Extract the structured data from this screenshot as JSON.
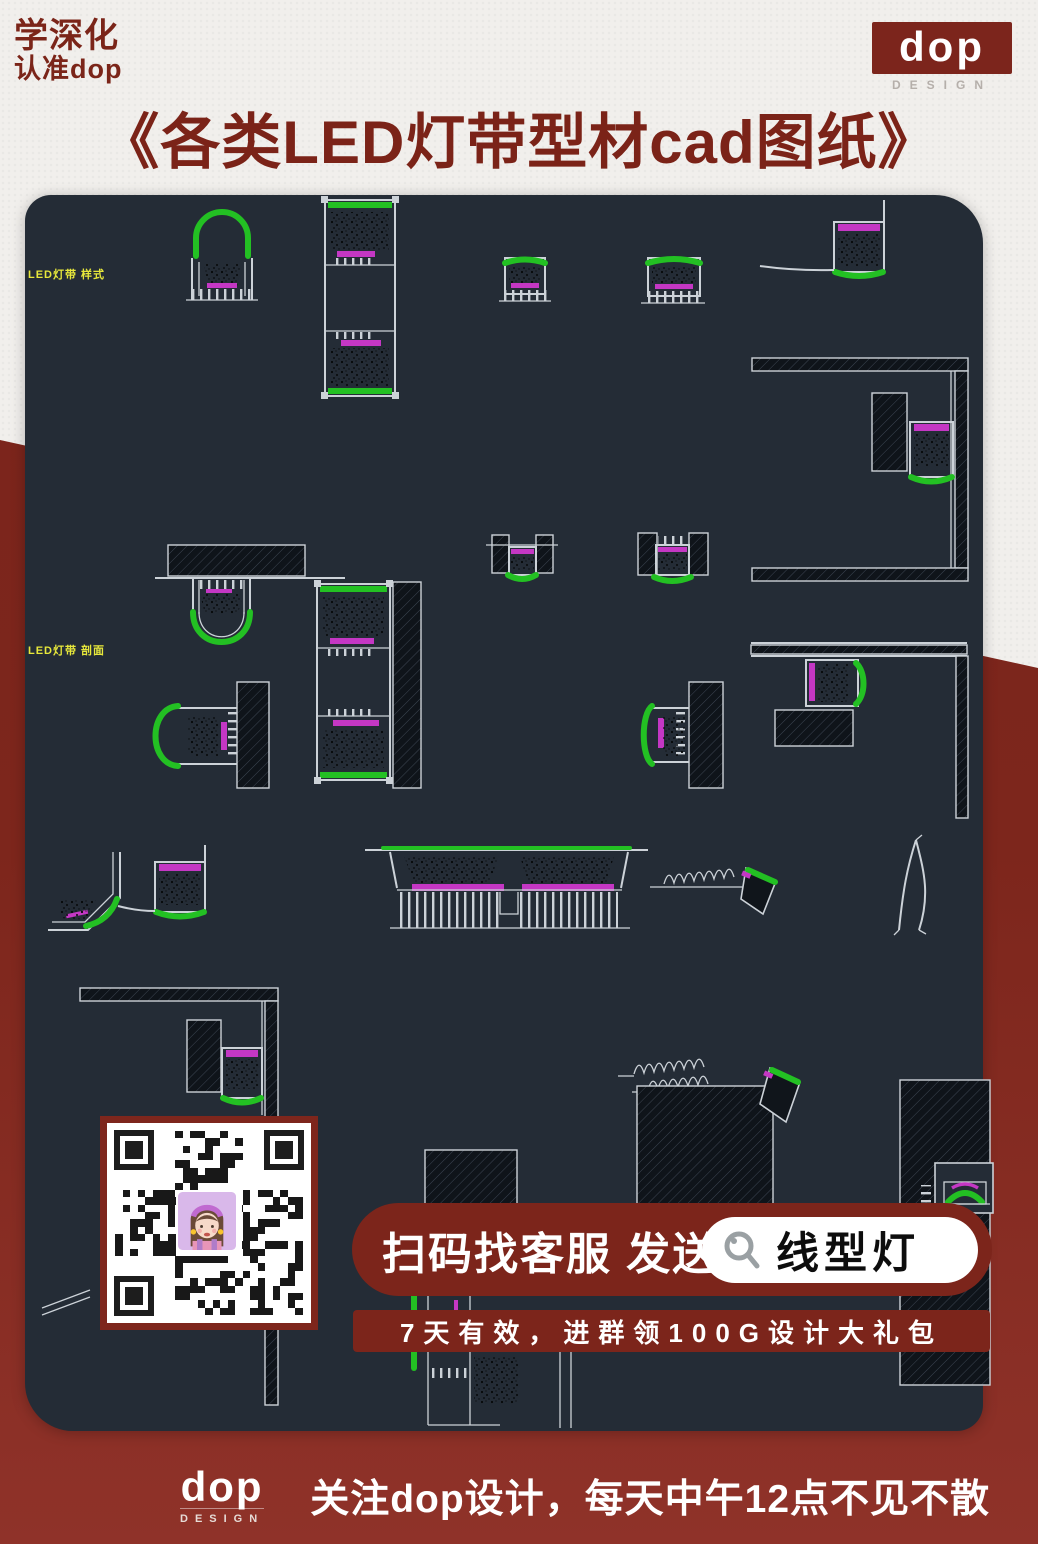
{
  "header": {
    "badge_line1": "学深化",
    "badge_line2": "认准dop",
    "logo": {
      "text": "dop",
      "subtext": "DESIGN"
    },
    "title": "《各类LED灯带型材cad图纸》"
  },
  "cad": {
    "labels": {
      "top": "LED灯带 样式",
      "middle": "LED灯带 剖面"
    }
  },
  "promo": {
    "scan_text": "扫码找客服 发送",
    "search_keyword": "线型灯",
    "search_icon": "magnifier-icon",
    "note": "7天有效，进群领100G设计大礼包"
  },
  "footer": {
    "logo": {
      "text": "dop",
      "subtext": "DESIGN"
    },
    "message": "关注dop设计，每天中午12点不见不散"
  },
  "colors": {
    "brand_red": "#7c251b",
    "canvas_bg": "#242c36",
    "cad_green": "#23c023",
    "cad_magenta": "#c437c4",
    "cad_line": "#ccd2d8",
    "label_yellow": "#e7e83b"
  }
}
